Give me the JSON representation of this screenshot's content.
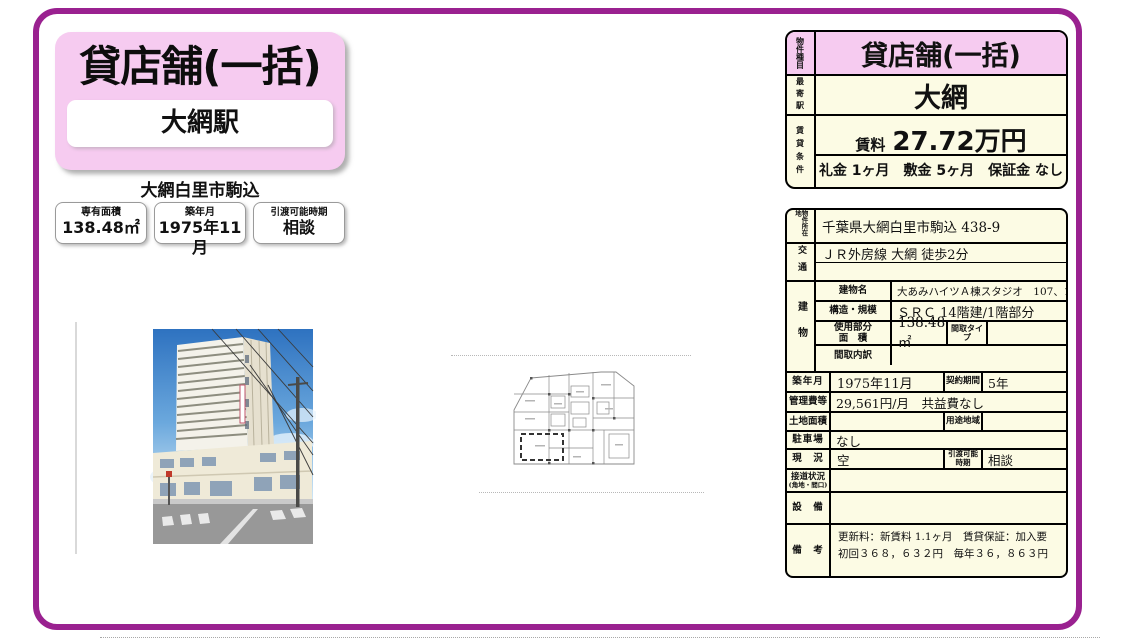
{
  "colors": {
    "frame_purple": "#9a2190",
    "title_pink": "#f6cbf0",
    "table_cream": "#fcfbe4"
  },
  "header": {
    "title": "貸店舗(一括)",
    "station": "大網駅",
    "location": "大網白里市駒込",
    "chips": [
      {
        "label": "専有面積",
        "value": "138.48㎡"
      },
      {
        "label": "築年月",
        "value": "1975年11月"
      },
      {
        "label": "引渡可能時期",
        "value": "相談"
      }
    ]
  },
  "summary": {
    "type_label": "物件種目",
    "type_value": "貸店舗(一括)",
    "station_label": "最寄駅",
    "station_value": "大網",
    "terms_label": "賃貸条件",
    "rent_label": "賃料",
    "rent_value": "27.72万円",
    "terms_value": "礼金 1ヶ月　敷金 5ヶ月　保証金 なし"
  },
  "detail": {
    "location_label": "物件所在地",
    "location_value": "千葉県大網白里市駒込 438-9",
    "access_label": "交通",
    "access_value": "ＪＲ外房線 大網 徒歩2分",
    "access_value2": "",
    "building_label": "建物",
    "building_name_label": "建物名",
    "building_name_value": "大あみハイツＡ棟スタジオ　107、110",
    "structure_label": "構造・規模",
    "structure_value": "ＳＲＣ 14階建/1階部分",
    "area_label_top": "使用部分",
    "area_label_bottom": "面　積",
    "area_value": "138.48㎡",
    "layout_type_label": "間取タイプ",
    "layout_type_value": "",
    "layout_breakdown_label": "間取内訳",
    "layout_breakdown_value": "",
    "built_label": "築年月",
    "built_value": "1975年11月",
    "contract_label": "契約期間",
    "contract_value": "5年",
    "management_label": "管理費等",
    "management_value": "29,561円/月　共益費なし",
    "land_label": "土地面積",
    "land_value": "",
    "zoning_label": "用途地域",
    "zoning_value": "",
    "parking_label": "駐車場",
    "parking_value": "なし",
    "status_label": "現　況",
    "status_value": "空",
    "handover_label": "引渡可能時期",
    "handover_value": "相談",
    "road_label": "接道状況",
    "road_label_sub": "(角地・間口)",
    "road_value": "",
    "equipment_label": "設　備",
    "equipment_value": "",
    "notes_label": "備　考",
    "notes_value": "更新料：新賃料 1.1ヶ月　賃貸保証：加入要 初回３６８，６３２円　毎年３６，８６３円"
  }
}
